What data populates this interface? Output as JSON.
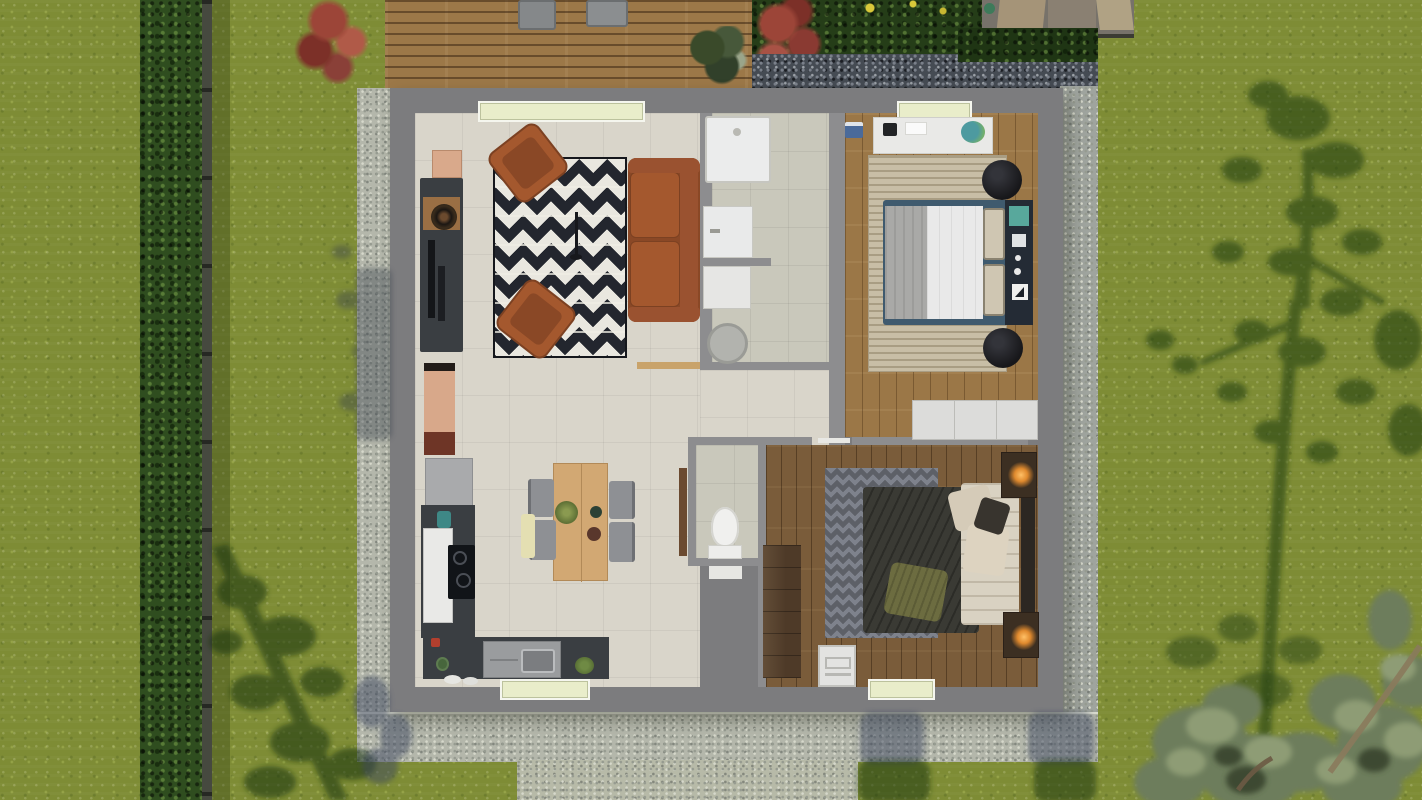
{
  "scene": {
    "description": "Top-down 3D architectural rendering of a single-storey two-bedroom house floor plan set in a garden with lawn, hedge, wooden deck and gravel borders",
    "view": "top-down orthographic render",
    "rooms": [
      {
        "id": "living-room",
        "furniture": [
          "tv-console",
          "record-player",
          "wall-tv",
          "zigzag-rug",
          "armchair",
          "armchair",
          "sofa",
          "floor-lamp",
          "sideboard"
        ]
      },
      {
        "id": "kitchen-dining",
        "furniture": [
          "tall-fridge",
          "cooktop",
          "kitchen-counter",
          "sink",
          "dining-table",
          "dining-chair",
          "dining-chair",
          "dining-chair",
          "dining-chair",
          "bench",
          "plant"
        ]
      },
      {
        "id": "bathroom",
        "furniture": [
          "shower-tray",
          "washbasin",
          "washing-machine",
          "laundry-basket"
        ]
      },
      {
        "id": "wc",
        "furniture": [
          "toilet",
          "door-leaf"
        ]
      },
      {
        "id": "bedroom-1",
        "furniture": [
          "desk",
          "laptop",
          "desk-chair",
          "striped-rug",
          "double-bed",
          "headboard-panel",
          "round-pouf",
          "round-pouf",
          "low-dresser"
        ]
      },
      {
        "id": "bedroom-2",
        "furniture": [
          "zigzag-rug",
          "double-bed",
          "wardrobe",
          "nightstand-with-lamp",
          "nightstand-with-lamp",
          "step-chair"
        ]
      },
      {
        "id": "hallway",
        "furniture": []
      }
    ],
    "outdoor": [
      "lawn",
      "hedge-row",
      "garden-fence-line",
      "wood-deck",
      "sun-lounger",
      "sun-lounger",
      "deck-plant",
      "red-shrub",
      "red-shrub",
      "yellow-flowers",
      "dark-gravel-bed",
      "garden-shed",
      "gravel-side-strip",
      "concrete-apron",
      "garden-path",
      "tree-shadow-large",
      "tree-shadow-small",
      "bottom-right-trees"
    ]
  },
  "colors": {
    "grass": "#7e8c35",
    "grassDark": "#55661f",
    "hedge": "#2f4d1f",
    "fence": "#46493f",
    "deckWood": "#9c7848",
    "bushRed": "#9c4538",
    "flowerYellow": "#d9c93a",
    "gravelDark": "#454b53",
    "gravelDarkDot": "#7a808a",
    "concrete": "#b4b7ab",
    "concreteDot": "#969b90",
    "concreteLight": "#d6d8cb",
    "wall": "#7c7c7e",
    "wallInner": "#8d8d8f",
    "tile": "#d9d5ca",
    "tileBath": "#c9c8bb",
    "woodBed1": "#9b7747",
    "woodBed2": "#7a5c3a",
    "window": "#e9edca",
    "windowFrame": "#f5f6ee",
    "rugDark": "#23262e",
    "rugWhite": "#e9e7df",
    "rust": "#a4582e",
    "rustDark": "#8a4826",
    "counter": "#3a3e42",
    "counterLight": "#a9aaac",
    "fridge": "#e9e9e7",
    "tableWood": "#d2a873",
    "chairGray": "#8e9094",
    "rugBeige": "#c8bea6",
    "pouf": "#17171a",
    "navy": "#242b35",
    "teal": "#58a89c",
    "duvetGray": "#a9a9a7",
    "duvetWhite": "#e9e9e9",
    "bedDark": "#3a3a34",
    "pillowOlive": "#6c6c40",
    "pillowBeige": "#d9d2c2",
    "headboard2": "#2c2722",
    "rug2": "#5d6067",
    "rug2Light": "#7e828c",
    "wardrobe": "#4e3a28",
    "shedTan": "#a59478",
    "shedGray": "#77726a",
    "white": "#ececea"
  }
}
